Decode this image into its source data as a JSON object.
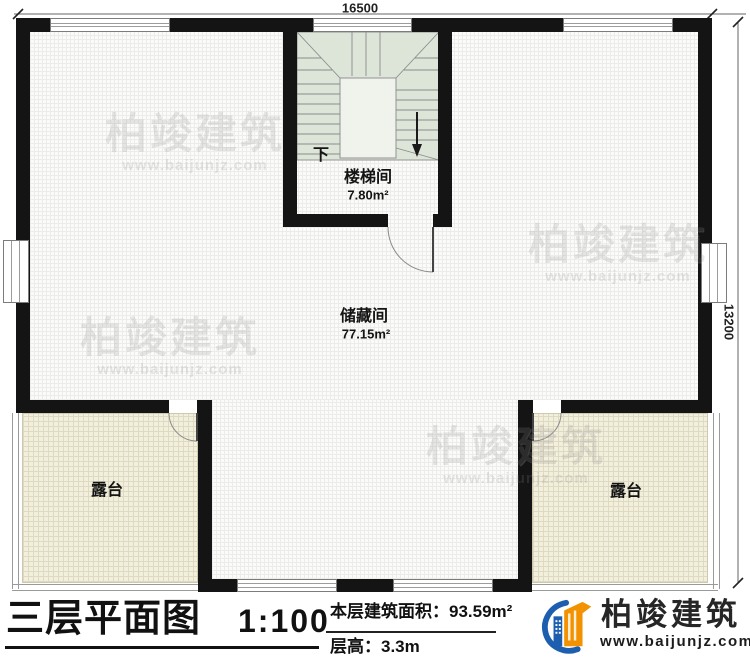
{
  "plan": {
    "dim_width": "16500",
    "dim_height": "13200",
    "stairwell": {
      "name": "楼梯间",
      "area": "7.80m²",
      "down_label": "下"
    },
    "storage": {
      "name": "储藏间",
      "area": "77.15m²"
    },
    "terrace_left": {
      "name": "露台"
    },
    "terrace_right": {
      "name": "露台"
    },
    "watermark": {
      "brand": "柏竣建筑",
      "url": "www.baijunjz.com"
    }
  },
  "titleblock": {
    "title": "三层平面图",
    "scale": "1:100",
    "area_label": "本层建筑面积：",
    "area_value": "93.59m²",
    "floor_height_label": "层高：",
    "floor_height_value": "3.3m",
    "logo": {
      "brand": "柏竣建筑",
      "url": "www.baijunjz.com"
    }
  },
  "colors": {
    "wall": "#141414",
    "stair_fill": "#dde5d9",
    "terrace_fill": "#f3efdd",
    "logo_blue": "#1d5fae",
    "logo_orange": "#f39200"
  }
}
